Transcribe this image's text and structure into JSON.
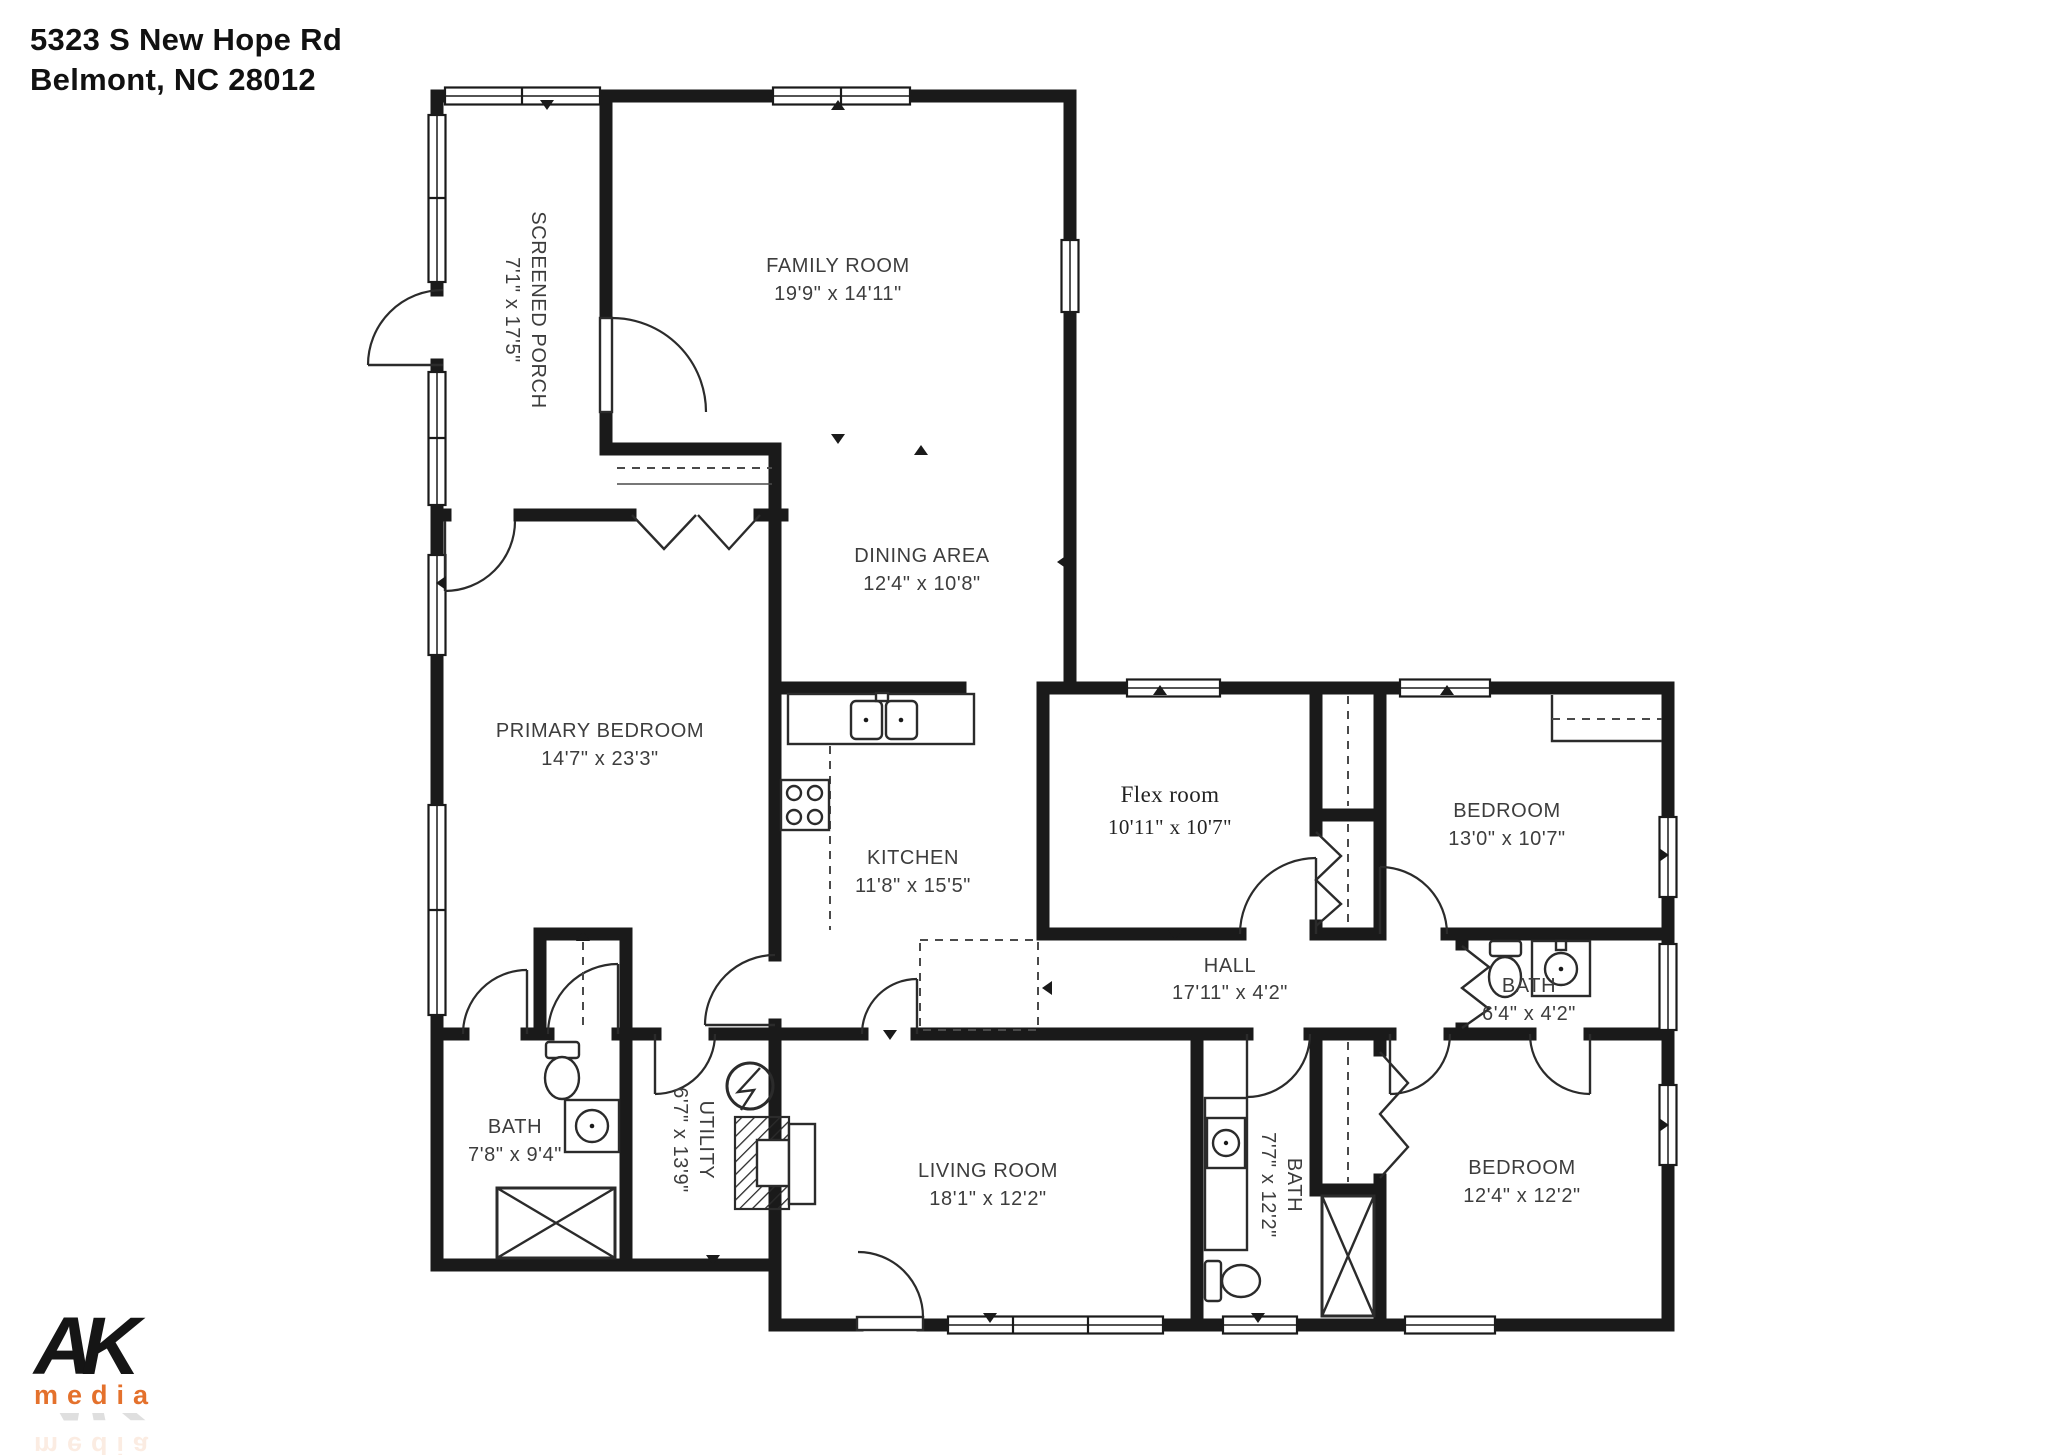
{
  "address": {
    "line1": "5323 S New Hope Rd",
    "line2": "Belmont, NC  28012"
  },
  "logo": {
    "top": "AK",
    "bottom": "media",
    "accent_color": "#e4712c"
  },
  "colors": {
    "wall": "#1a1a1a",
    "label_text": "#3d3d3d",
    "background": "#ffffff"
  },
  "rooms": [
    {
      "id": "screened-porch",
      "name": "SCREENED PORCH",
      "dims": "7'1\" x 17'5\"",
      "orientation": "vertical"
    },
    {
      "id": "family-room",
      "name": "FAMILY ROOM",
      "dims": "19'9\" x 14'11\"",
      "orientation": "horizontal"
    },
    {
      "id": "dining-area",
      "name": "DINING AREA",
      "dims": "12'4\" x 10'8\"",
      "orientation": "horizontal"
    },
    {
      "id": "primary-bedroom",
      "name": "PRIMARY BEDROOM",
      "dims": "14'7\" x 23'3\"",
      "orientation": "horizontal"
    },
    {
      "id": "kitchen",
      "name": "KITCHEN",
      "dims": "11'8\" x 15'5\"",
      "orientation": "horizontal"
    },
    {
      "id": "flex-room",
      "name": "Flex room",
      "dims": "10'11\" x 10'7\"",
      "orientation": "horizontal"
    },
    {
      "id": "bedroom-top-right",
      "name": "BEDROOM",
      "dims": "13'0\" x 10'7\"",
      "orientation": "horizontal"
    },
    {
      "id": "hall",
      "name": "HALL",
      "dims": "17'11\" x 4'2\"",
      "orientation": "horizontal"
    },
    {
      "id": "bath-right",
      "name": "BATH",
      "dims": "6'4\" x 4'2\"",
      "orientation": "horizontal"
    },
    {
      "id": "bath-left",
      "name": "BATH",
      "dims": "7'8\" x 9'4\"",
      "orientation": "horizontal"
    },
    {
      "id": "utility",
      "name": "UTILITY",
      "dims": "6'7\" x 13'9\"",
      "orientation": "vertical"
    },
    {
      "id": "living-room",
      "name": "LIVING ROOM",
      "dims": "18'1\" x 12'2\"",
      "orientation": "horizontal"
    },
    {
      "id": "bath-middle",
      "name": "BATH",
      "dims": "7'7\" x 12'2\"",
      "orientation": "vertical"
    },
    {
      "id": "bedroom-bottom-right",
      "name": "BEDROOM",
      "dims": "12'4\" x 12'2\"",
      "orientation": "horizontal"
    }
  ]
}
